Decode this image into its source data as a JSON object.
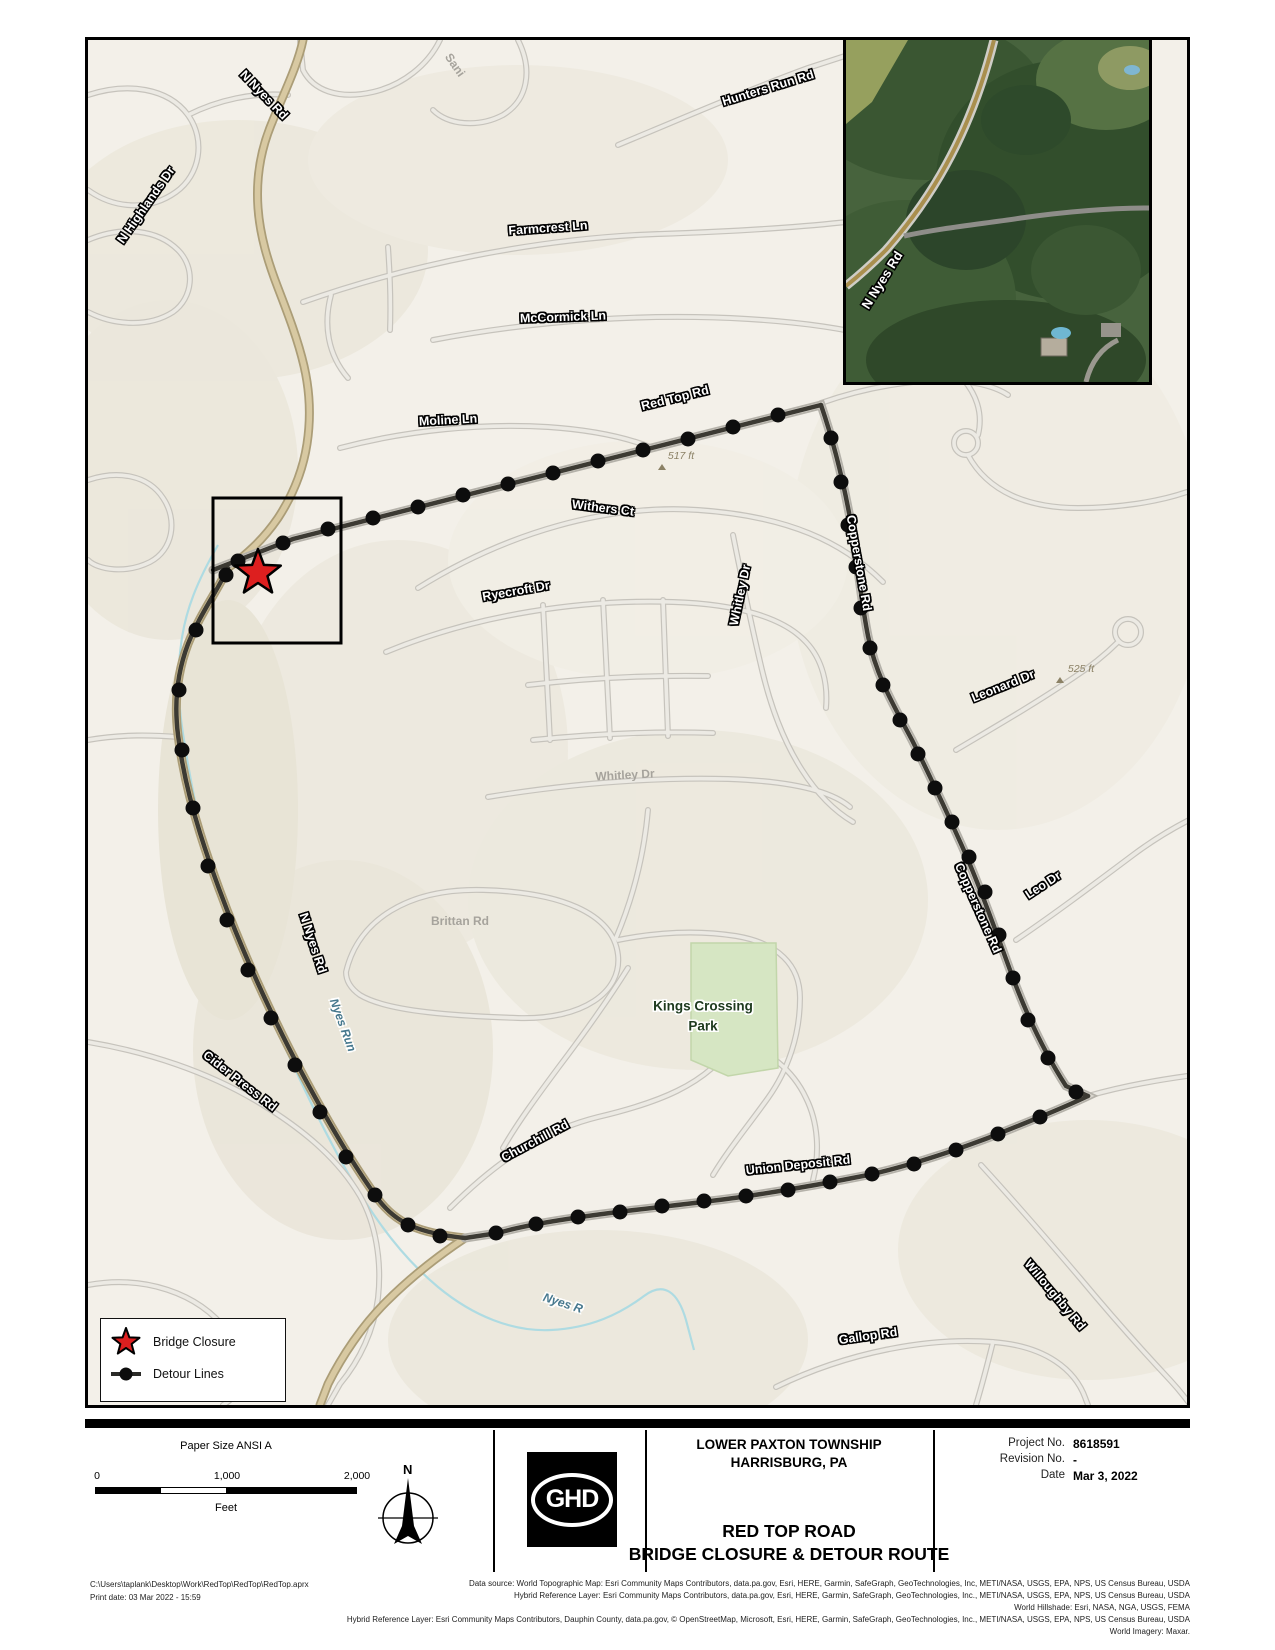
{
  "map": {
    "labels": {
      "n_nyes_rd_top": "N Nyes Rd",
      "n_highlands_dr": "N Highlands Dr",
      "hunters_run_rd": "Hunters Run Rd",
      "sani_partial": "Sani",
      "farmcrest_ln": "Farmcrest Ln",
      "mccormick_ln": "McCormick Ln",
      "moline_ln": "Moline Ln",
      "red_top_rd": "Red Top Rd",
      "elev_517": "517 ft",
      "withers_ct": "Withers Ct",
      "ryecroft_dr": "Ryecroft Dr",
      "whitley_dr_vertical": "Whitley Dr",
      "whitley_dr_gray": "Whitley Dr",
      "copperstone_rd_upper": "Copperstone Rd",
      "copperstone_rd_lower": "Copperstone Rd",
      "leonard_dr": "Leonard Dr",
      "elev_525": "525 ft",
      "leo_dr": "Leo Dr",
      "brittan_rd": "Brittan Rd",
      "n_nyes_rd_mid": "N Nyes Rd",
      "nyes_run": "Nyes Run",
      "cider_press_rd": "Cider Press Rd",
      "churchill_rd": "Churchill Rd",
      "kings_line1": "Kings Crossing",
      "kings_line2": "Park",
      "union_deposit_rd": "Union Deposit Rd",
      "willoughby_rd": "Willoughby Rd",
      "gallop_rd": "Gallop Rd",
      "nyes_run_lower": "Nyes R"
    },
    "inset_label": "N Nyes Rd"
  },
  "legend": {
    "bridge_closure": "Bridge Closure",
    "detour_lines": "Detour Lines"
  },
  "titleblock": {
    "paper_size": "Paper Size ANSI A",
    "scale_ticks": [
      "0",
      "1,000",
      "2,000"
    ],
    "scale_units": "Feet",
    "north_label": "N",
    "logo": "GHD",
    "client_line1": "LOWER PAXTON TOWNSHIP",
    "client_line2": "HARRISBURG, PA",
    "title_line1": "RED TOP ROAD",
    "title_line2": "BRIDGE CLOSURE & DETOUR ROUTE",
    "project_no_label": "Project No.",
    "project_no": "8618591",
    "revision_no_label": "Revision No.",
    "revision_no": "-",
    "date_label": "Date",
    "date": "Mar 3, 2022"
  },
  "footer": {
    "path": "C:\\Users\\taplank\\Desktop\\Work\\RedTop\\RedTop\\RedTop.aprx",
    "print_date": "Print date: 03 Mar 2022 - 15:59",
    "credits": [
      "Data source:  World Topographic Map: Esri Community Maps Contributors, data.pa.gov, Esri, HERE, Garmin, SafeGraph, GeoTechnologies, Inc, METI/NASA, USGS, EPA, NPS, US Census Bureau, USDA",
      "Hybrid Reference Layer: Esri Community Maps Contributors, data.pa.gov, Esri, HERE, Garmin, SafeGraph, GeoTechnologies, Inc., METI/NASA, USGS, EPA, NPS, US Census Bureau, USDA",
      "World Hillshade: Esri, NASA, NGA, USGS, FEMA",
      "Hybrid Reference Layer: Esri Community Maps Contributors, Dauphin County, data.pa.gov, © OpenStreetMap, Microsoft, Esri, HERE, Garmin, SafeGraph, GeoTechnologies, Inc., METI/NASA, USGS, EPA, NPS, US Census Bureau, USDA",
      "World Imagery: Maxar."
    ]
  },
  "colors": {
    "closure_star": "#dd1f1f",
    "detour_line": "#3c3a33",
    "park_green": "#d6e6c3",
    "stream_blue": "#aedbe2",
    "major_road_tan": "#d8c9a2",
    "map_base": "#f3f0e9"
  }
}
